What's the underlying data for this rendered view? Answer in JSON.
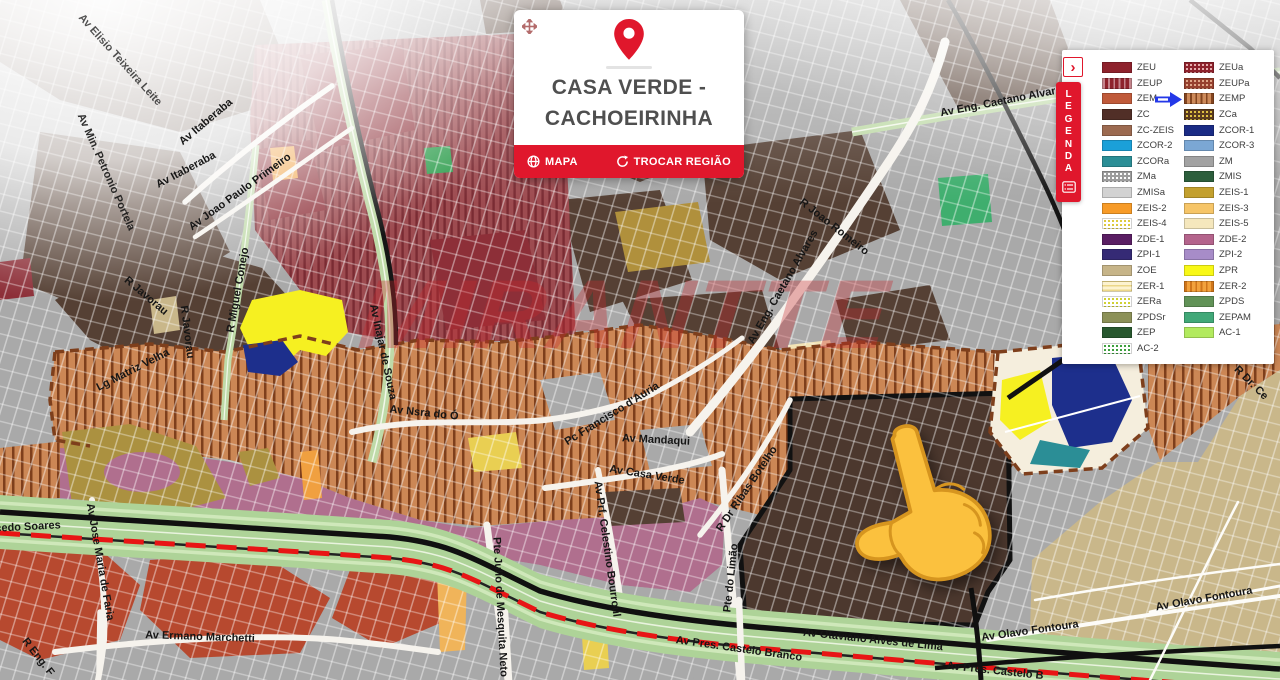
{
  "watermark": "MIRANTTE",
  "region_card": {
    "title_line1": "CASA VERDE -",
    "title_line2": "CACHOEIRINHA",
    "map_button": "MAPA",
    "change_region_button": "TROCAR REGIÃO"
  },
  "legend": {
    "tab_title": "LEGENDA",
    "collapse_glyph": "›",
    "highlight": "ZEMP",
    "left": [
      {
        "label": "ZEU",
        "color": "#8e222c",
        "pattern": "solid"
      },
      {
        "label": "ZEUP",
        "color": "#8e222c",
        "pattern": "vstripe",
        "accent": "#c4848c"
      },
      {
        "label": "ZEM",
        "color": "#c05a3a",
        "pattern": "solid"
      },
      {
        "label": "ZC",
        "color": "#512f27",
        "pattern": "solid"
      },
      {
        "label": "ZC-ZEIS",
        "color": "#9c6a50",
        "pattern": "solid"
      },
      {
        "label": "ZCOR-2",
        "color": "#1ba0d8",
        "pattern": "solid"
      },
      {
        "label": "ZCORa",
        "color": "#2b8e96",
        "pattern": "solid"
      },
      {
        "label": "ZMa",
        "color": "#9c9c9c",
        "pattern": "dots",
        "accent": "#ffffff"
      },
      {
        "label": "ZMISa",
        "color": "#d2d2d2",
        "pattern": "solid"
      },
      {
        "label": "ZEIS-2",
        "color": "#f79b28",
        "pattern": "solid"
      },
      {
        "label": "ZEIS-4",
        "color": "#ffffff",
        "pattern": "dots",
        "accent": "#ddc93a"
      },
      {
        "label": "ZDE-1",
        "color": "#5a1e63",
        "pattern": "solid"
      },
      {
        "label": "ZPI-1",
        "color": "#352a75",
        "pattern": "solid"
      },
      {
        "label": "ZOE",
        "color": "#c6b488",
        "pattern": "solid"
      },
      {
        "label": "ZER-1",
        "color": "#fdf3cf",
        "pattern": "hstripe",
        "accent": "#ecd788"
      },
      {
        "label": "ZERa",
        "color": "#ffffff",
        "pattern": "dots",
        "accent": "#cfd02f"
      },
      {
        "label": "ZPDSr",
        "color": "#8c9158",
        "pattern": "solid"
      },
      {
        "label": "ZEP",
        "color": "#28582f",
        "pattern": "solid"
      },
      {
        "label": "AC-2",
        "color": "#ffffff",
        "pattern": "dots",
        "accent": "#3a9e3a"
      }
    ],
    "right": [
      {
        "label": "ZEUa",
        "color": "#8e222c",
        "pattern": "dots",
        "accent": "#e8b0b0"
      },
      {
        "label": "ZEUPa",
        "color": "#96402e",
        "pattern": "dots",
        "accent": "#e0a88a"
      },
      {
        "label": "ZEMP",
        "color": "#cd8a5a",
        "pattern": "vstripe",
        "accent": "#84451f"
      },
      {
        "label": "ZCa",
        "color": "#5a3a1e",
        "pattern": "dots",
        "accent": "#e3c243"
      },
      {
        "label": "ZCOR-1",
        "color": "#1a2b85",
        "pattern": "solid"
      },
      {
        "label": "ZCOR-3",
        "color": "#7ba7d4",
        "pattern": "solid"
      },
      {
        "label": "ZM",
        "color": "#a2a2a2",
        "pattern": "solid"
      },
      {
        "label": "ZMIS",
        "color": "#2c5e3c",
        "pattern": "solid"
      },
      {
        "label": "ZEIS-1",
        "color": "#c3a02e",
        "pattern": "solid"
      },
      {
        "label": "ZEIS-3",
        "color": "#f6c568",
        "pattern": "solid"
      },
      {
        "label": "ZEIS-5",
        "color": "#f5e7bd",
        "pattern": "solid"
      },
      {
        "label": "ZDE-2",
        "color": "#b4648c",
        "pattern": "solid"
      },
      {
        "label": "ZPI-2",
        "color": "#a78cc8",
        "pattern": "solid"
      },
      {
        "label": "ZPR",
        "color": "#f8f816",
        "pattern": "solid"
      },
      {
        "label": "ZER-2",
        "color": "#f2a23c",
        "pattern": "vstripe",
        "accent": "#d0761a"
      },
      {
        "label": "ZPDS",
        "color": "#619257",
        "pattern": "solid"
      },
      {
        "label": "ZEPAM",
        "color": "#41a878",
        "pattern": "solid"
      },
      {
        "label": "AC-1",
        "color": "#b2ea5e",
        "pattern": "solid"
      }
    ]
  },
  "map": {
    "street_labels": [
      {
        "t": "Av Elisio Teixeira Leite",
        "x": 120,
        "y": 60,
        "r": 48,
        "o": 0.75
      },
      {
        "t": "Av Min. Petronio Portela",
        "x": 106,
        "y": 172,
        "r": 66,
        "o": 0.9
      },
      {
        "t": "Av Itaberaba",
        "x": 206,
        "y": 122,
        "r": -40
      },
      {
        "t": "Av Itaberaba",
        "x": 186,
        "y": 170,
        "r": -28
      },
      {
        "t": "Av Joao Paulo Primeiro",
        "x": 240,
        "y": 192,
        "r": -36
      },
      {
        "t": "R Miguel Conejo",
        "x": 238,
        "y": 290,
        "r": -80
      },
      {
        "t": "R Javorau",
        "x": 146,
        "y": 296,
        "r": 40
      },
      {
        "t": "R Javorau",
        "x": 187,
        "y": 332,
        "r": 83
      },
      {
        "t": "Lg Matriz Velha",
        "x": 133,
        "y": 370,
        "r": -27
      },
      {
        "t": "Av Inajar de Souza",
        "x": 383,
        "y": 352,
        "r": 78
      },
      {
        "t": "Av Nsra do Ó",
        "x": 424,
        "y": 413,
        "r": 6
      },
      {
        "t": "Pc Francisco d'Auria",
        "x": 612,
        "y": 414,
        "r": -32
      },
      {
        "t": "Av Mandaqui",
        "x": 656,
        "y": 440,
        "r": 3
      },
      {
        "t": "Av Casa Verde",
        "x": 647,
        "y": 475,
        "r": 9
      },
      {
        "t": "R Dr Ribas Botelho",
        "x": 747,
        "y": 489,
        "r": -56
      },
      {
        "t": "Pte do Limão",
        "x": 731,
        "y": 578,
        "r": -84
      },
      {
        "t": "Av Prf. Celestino Bourroul",
        "x": 607,
        "y": 549,
        "r": 82
      },
      {
        "t": "Pte Julio de Mesquita Neto",
        "x": 500,
        "y": 607,
        "r": 87
      },
      {
        "t": "Av Eng. Caetano Alvares",
        "x": 783,
        "y": 287,
        "r": -60
      },
      {
        "t": "R Joao Romeiro",
        "x": 834,
        "y": 227,
        "r": 38
      },
      {
        "t": "Av Eng. Caetano Alvares",
        "x": 1004,
        "y": 101,
        "r": -11
      },
      {
        "t": "cedo Soares",
        "x": 28,
        "y": 527,
        "r": -3
      },
      {
        "t": "Av Jose Maria de Faria",
        "x": 100,
        "y": 562,
        "r": 80
      },
      {
        "t": "Av Ermano Marchetti",
        "x": 200,
        "y": 637,
        "r": 2
      },
      {
        "t": "R Eng. F",
        "x": 38,
        "y": 657,
        "r": 52
      },
      {
        "t": "Av Otaviano Alves de Lima",
        "x": 873,
        "y": 640,
        "r": 6
      },
      {
        "t": "Av Pres. Castelo Branco",
        "x": 739,
        "y": 649,
        "r": 8
      },
      {
        "t": "Av Pres. Castelo B",
        "x": 995,
        "y": 671,
        "r": 6
      },
      {
        "t": "Av Olavo Fontoura",
        "x": 1030,
        "y": 631,
        "r": -8
      },
      {
        "t": "Av Olavo Fontoura",
        "x": 1204,
        "y": 599,
        "r": -10
      },
      {
        "t": "R Dr. Ce",
        "x": 1251,
        "y": 383,
        "r": 45
      }
    ]
  },
  "colors": {
    "accent_red": "#e0172c",
    "arrow_blue": "#2438e8",
    "watermark_red": "#c9303c"
  }
}
